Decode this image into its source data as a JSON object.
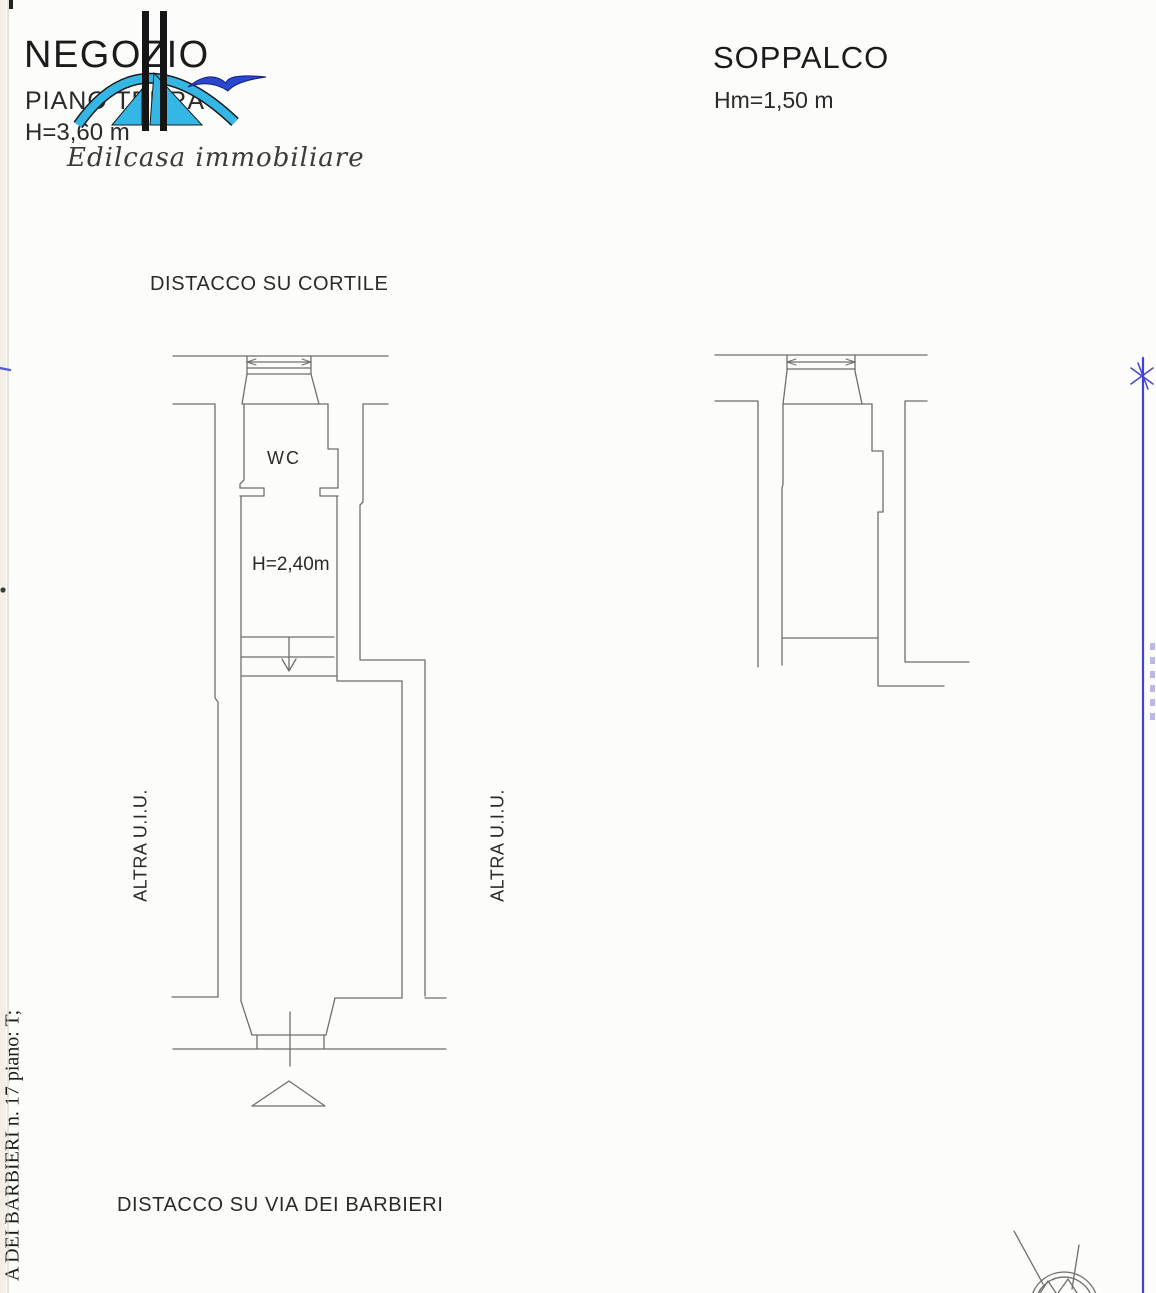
{
  "header": {
    "left": {
      "title": "NEGOZIO",
      "floor": "PIANO TERRA",
      "height": "H=3,60 m",
      "logo_caption": "Edilcasa immobiliare"
    },
    "right": {
      "title": "SOPPALCO",
      "height": "Hm=1,50 m"
    }
  },
  "labels": {
    "top_boundary": "DISTACCO SU CORTILE",
    "wc": "WC",
    "corridor_height": "H=2,40m",
    "adjacent_left": "ALTRA U.I.U.",
    "adjacent_right": "ALTRA U.I.U.",
    "bottom_boundary": "DISTACCO SU VIA DEI BARBIERI",
    "margin_note": "A DEI BARBIERI n. 17 piano: T;"
  },
  "colors": {
    "plan_line": "#6e6e6e",
    "logo_cyan": "#35b7e6",
    "logo_blue": "#2948cf",
    "margin_blue_line": "#4343d6",
    "text": "#1b1b1b"
  }
}
